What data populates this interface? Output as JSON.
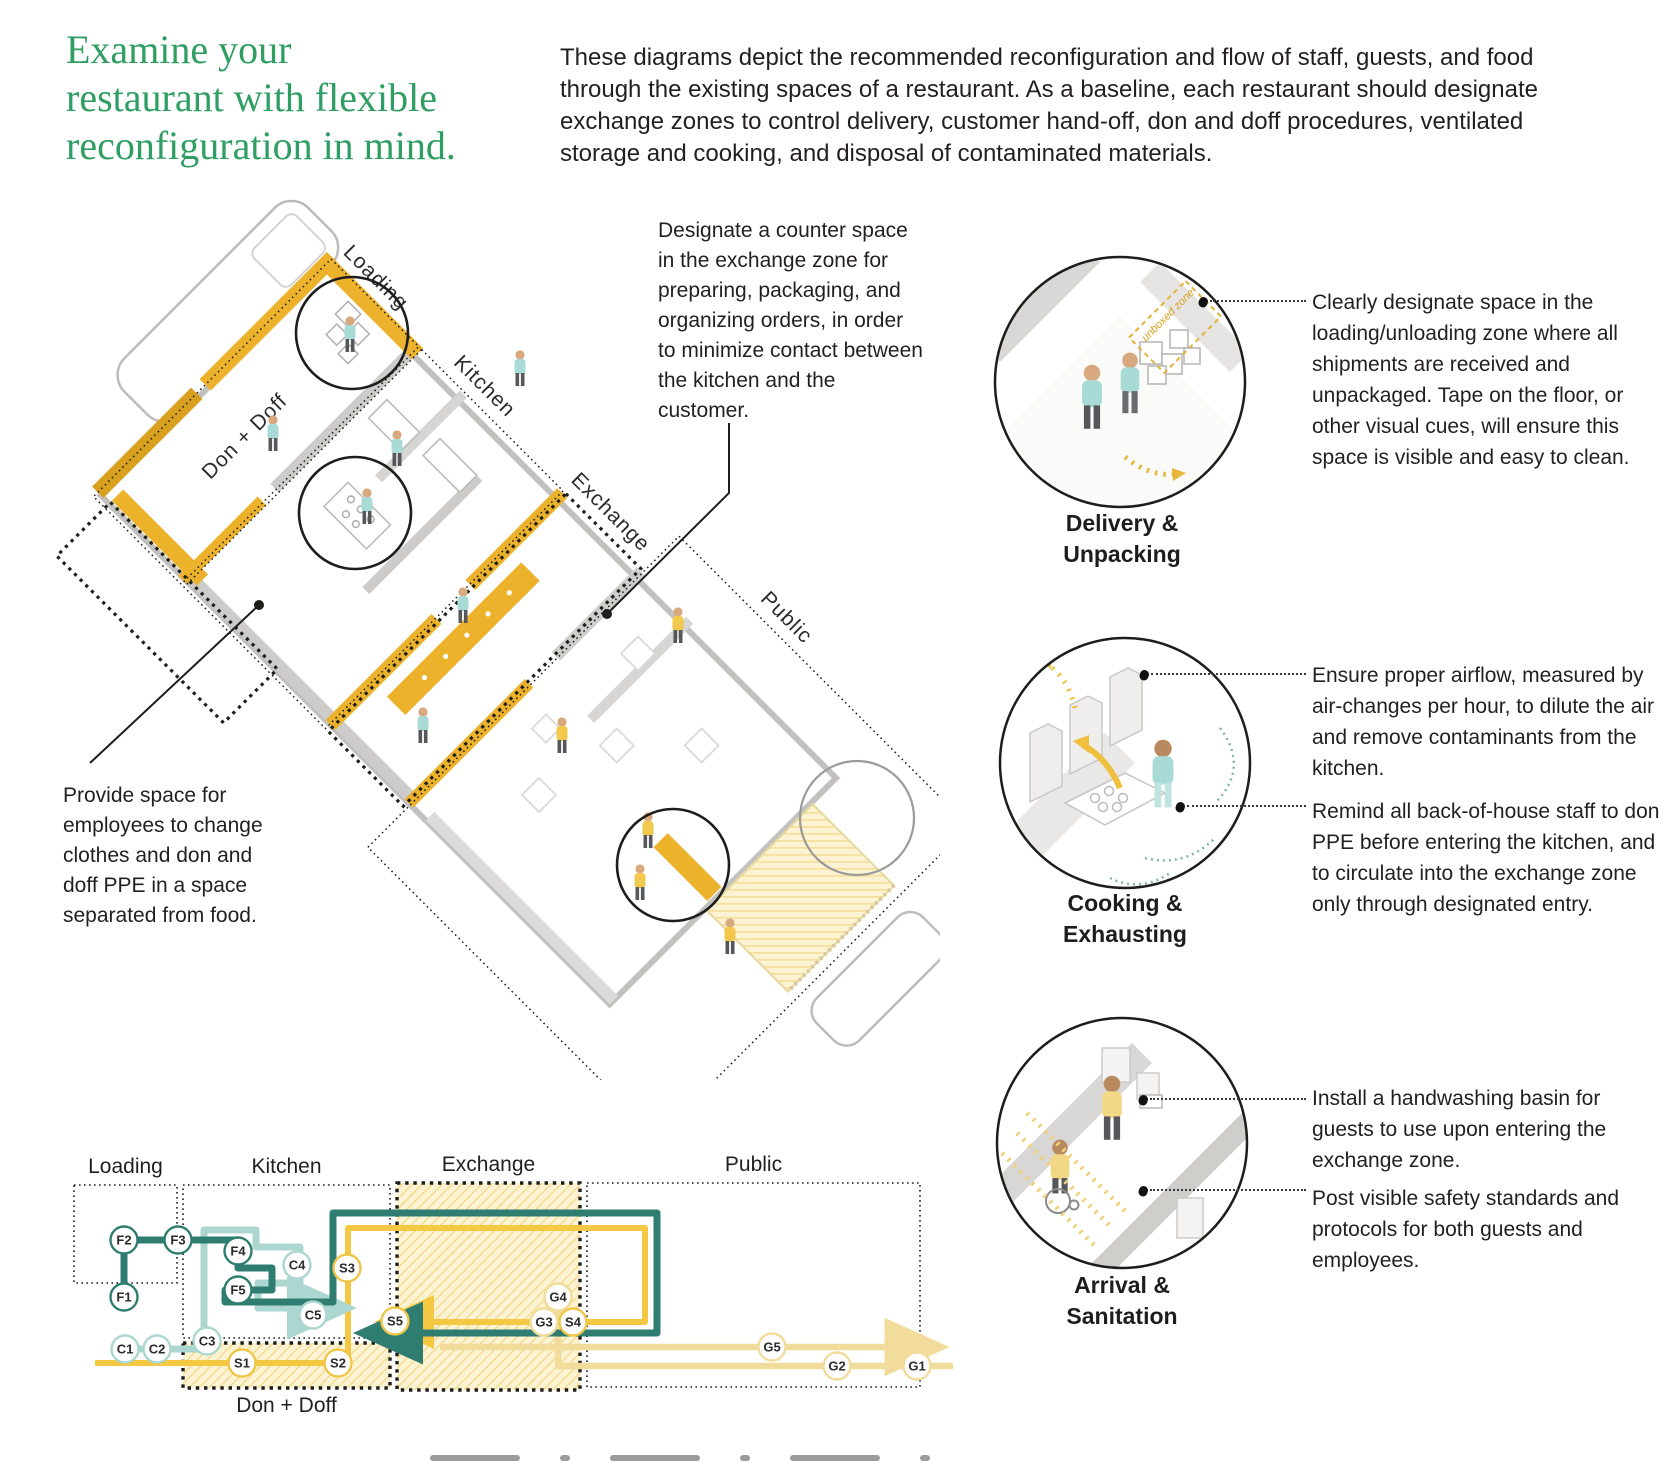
{
  "page": {
    "title_lines": [
      "Examine your",
      "restaurant with flexible",
      "reconfiguration in mind."
    ],
    "intro": "These diagrams depict the recommended reconfiguration and flow of staff, guests, and food through the existing spaces of a restaurant. As a baseline, each restaurant should designate exchange zones to control delivery, customer hand-off, don and doff procedures, ventilated storage and cooking, and disposal of contaminated materials."
  },
  "axon": {
    "zone_labels": {
      "loading": "Loading",
      "kitchen": "Kitchen",
      "exchange": "Exchange",
      "public": "Public",
      "don_doff": "Don + Doff"
    },
    "counter_note": "Designate a counter space in the exchange zone for preparing, packaging, and organizing orders, in order to minimize contact between the kitchen and the customer.",
    "ppe_note": "Provide space for employees to change clothes and don and doff PPE in a space separated from food.",
    "figures": [
      {
        "x": 310,
        "y": 156,
        "shirt": "teal"
      },
      {
        "x": 233,
        "y": 255,
        "shirt": "teal"
      },
      {
        "x": 357,
        "y": 270,
        "shirt": "teal"
      },
      {
        "x": 480,
        "y": 190,
        "shirt": "teal"
      },
      {
        "x": 327,
        "y": 328,
        "shirt": "teal"
      },
      {
        "x": 423,
        "y": 427,
        "shirt": "teal"
      },
      {
        "x": 383,
        "y": 547,
        "shirt": "teal"
      },
      {
        "x": 638,
        "y": 447,
        "shirt": "yellow"
      },
      {
        "x": 522,
        "y": 557,
        "shirt": "yellow"
      },
      {
        "x": 608,
        "y": 652,
        "shirt": "yellow"
      },
      {
        "x": 600,
        "y": 704,
        "shirt": "yellow"
      },
      {
        "x": 690,
        "y": 758,
        "shirt": "yellow"
      }
    ]
  },
  "vignettes": [
    {
      "title_lines": [
        "Delivery &",
        "Unpacking"
      ],
      "inner_label": "unboxed zone",
      "annotations": [
        {
          "text": "Clearly designate space in the loading/unloading zone where all shipments are received and unpackaged. Tape on the floor, or other visual cues, will ensure this space is visible and easy to clean."
        }
      ]
    },
    {
      "title_lines": [
        "Cooking &",
        "Exhausting"
      ],
      "annotations": [
        {
          "text": "Ensure proper airflow, measured by air-changes per hour, to dilute the air and remove contaminants from the kitchen."
        },
        {
          "text": "Remind all back-of-house staff to don PPE before entering the kitchen, and to circulate into the exchange zone only through designated entry."
        }
      ]
    },
    {
      "title_lines": [
        "Arrival &",
        "Sanitation"
      ],
      "annotations": [
        {
          "text": "Install a handwashing basin for guests to use upon entering the exchange zone."
        },
        {
          "text": "Post visible safety standards and protocols for both guests and employees."
        }
      ]
    }
  ],
  "flow": {
    "colors": {
      "food": "#2F7D71",
      "contaminated": "#ACD6D0",
      "staff": "#F5C844",
      "guest": "#F2DC9B"
    },
    "zones": [
      {
        "id": "loading",
        "label": "Loading",
        "x": 34,
        "y": 45,
        "w": 103,
        "h": 98,
        "style": "fine",
        "hatched": false
      },
      {
        "id": "kitchen",
        "label": "Kitchen",
        "x": 143,
        "y": 45,
        "w": 207,
        "h": 153,
        "style": "fine",
        "hatched": false
      },
      {
        "id": "public",
        "label": "Public",
        "x": 547,
        "y": 43,
        "w": 333,
        "h": 204,
        "style": "fine",
        "hatched": false
      },
      {
        "id": "exchange",
        "label": "Exchange",
        "x": 357,
        "y": 43,
        "w": 183,
        "h": 207,
        "style": "bold",
        "hatched": true
      },
      {
        "id": "dondoff",
        "label": "Don + Doff",
        "x": 143,
        "y": 203,
        "w": 207,
        "h": 45,
        "style": "bold",
        "hatched": true,
        "label_below": true
      }
    ],
    "nodes": [
      {
        "id": "F1",
        "x": 84,
        "y": 157,
        "t": "food"
      },
      {
        "id": "F2",
        "x": 84,
        "y": 100,
        "t": "food"
      },
      {
        "id": "F3",
        "x": 138,
        "y": 100,
        "t": "food"
      },
      {
        "id": "F4",
        "x": 198,
        "y": 111,
        "t": "food"
      },
      {
        "id": "F5",
        "x": 198,
        "y": 150,
        "t": "food"
      },
      {
        "id": "C1",
        "x": 85,
        "y": 209,
        "t": "contaminated"
      },
      {
        "id": "C2",
        "x": 117,
        "y": 209,
        "t": "contaminated"
      },
      {
        "id": "C3",
        "x": 167,
        "y": 201,
        "t": "contaminated"
      },
      {
        "id": "C4",
        "x": 257,
        "y": 125,
        "t": "contaminated"
      },
      {
        "id": "C5",
        "x": 273,
        "y": 175,
        "t": "contaminated"
      },
      {
        "id": "S1",
        "x": 202,
        "y": 223,
        "t": "staff"
      },
      {
        "id": "S2",
        "x": 298,
        "y": 223,
        "t": "staff"
      },
      {
        "id": "S3",
        "x": 307,
        "y": 128,
        "t": "staff"
      },
      {
        "id": "S5",
        "x": 355,
        "y": 181,
        "t": "staff"
      },
      {
        "id": "S4",
        "x": 533,
        "y": 182,
        "t": "staff"
      },
      {
        "id": "G3",
        "x": 504,
        "y": 182,
        "t": "guest"
      },
      {
        "id": "G4",
        "x": 518,
        "y": 157,
        "t": "guest"
      },
      {
        "id": "G5",
        "x": 732,
        "y": 207,
        "t": "guest"
      },
      {
        "id": "G2",
        "x": 797,
        "y": 226,
        "t": "guest"
      },
      {
        "id": "G1",
        "x": 877,
        "y": 226,
        "t": "guest"
      }
    ]
  }
}
